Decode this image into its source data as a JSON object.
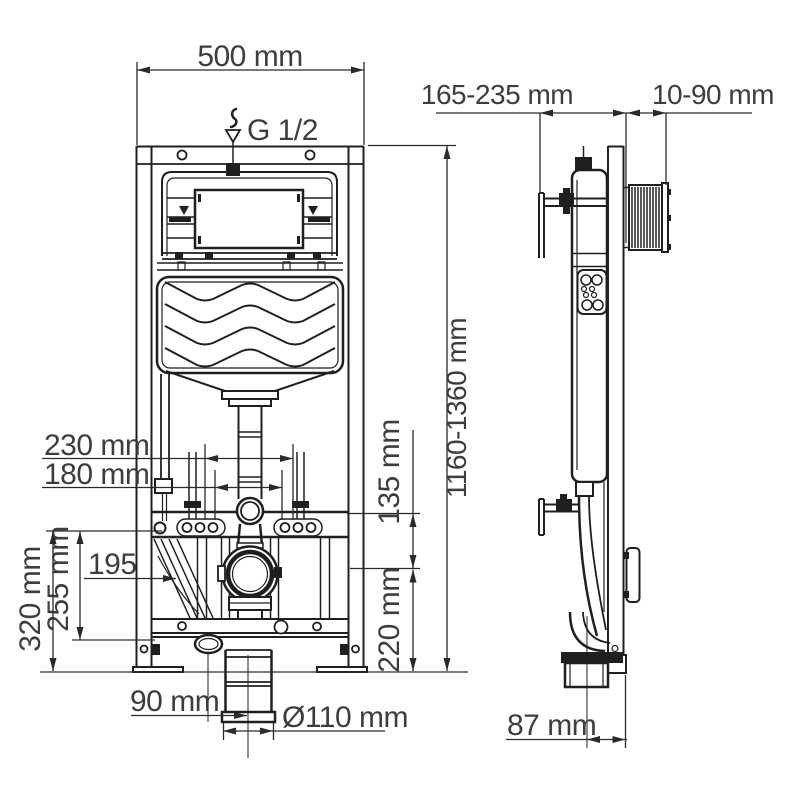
{
  "drawing": {
    "type": "toilet-installation-frame technical drawing",
    "background": "#ffffff",
    "colors": {
      "line": "#1f1f1f",
      "dimension_line": "#2a2a2a",
      "text": "#3d3d3d"
    },
    "icons": {
      "water_inlet_icon": "drop-above-funnel"
    }
  },
  "dims": {
    "frame_width": "500 mm",
    "water_inlet": "G 1/2",
    "depth_range": "165-235 mm",
    "plate_depth": "10-90 mm",
    "height_range": "1160-1360 mm",
    "bolt_spacing_outer": "230 mm",
    "bolt_spacing_inner": "180 mm",
    "flush_pipe_offset": "135 mm",
    "supply_position": "195",
    "bend_height": "255 mm",
    "frame_bottom_height": "320 mm",
    "outlet_axis_height": "220 mm",
    "outlet_offset": "90 mm",
    "outlet_diameter": "Ø110 mm",
    "side_outlet_depth": "87 mm"
  }
}
